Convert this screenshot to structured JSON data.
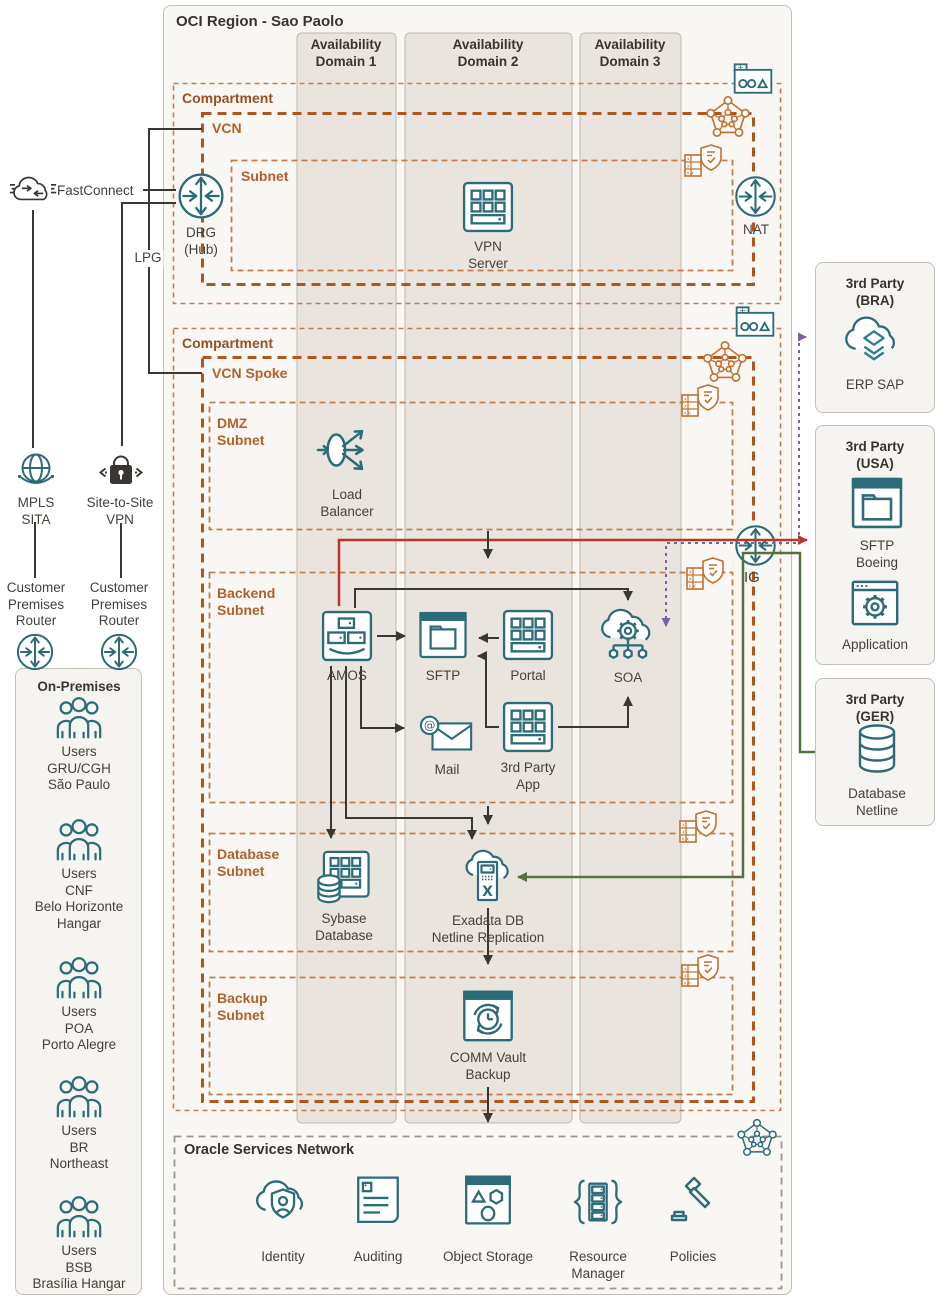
{
  "region_title": "OCI Region - Sao Paolo",
  "ad": {
    "d1": [
      "Availability",
      "Domain 1"
    ],
    "d2": [
      "Availability",
      "Domain 2"
    ],
    "d3": [
      "Availability",
      "Domain 3"
    ]
  },
  "comp1": {
    "label": "Compartment",
    "vcn_label": "VCN",
    "subnet_label": "Subnet",
    "vpn_server": [
      "VPN",
      "Server"
    ],
    "drg": [
      "DRG",
      "(Hub)"
    ],
    "nat": "NAT"
  },
  "comp2": {
    "label": "Compartment",
    "vcn_label": "VCN Spoke",
    "dmz_label": [
      "DMZ",
      "Subnet"
    ],
    "load_balancer": [
      "Load",
      "Balancer"
    ],
    "backend_label": [
      "Backend",
      "Subnet"
    ],
    "amos": "AMOS",
    "sftp": "SFTP",
    "portal": "Portal",
    "soa": "SOA",
    "mail": "Mail",
    "third_party_app": [
      "3rd Party",
      "App"
    ],
    "ig": "IG",
    "database_label": [
      "Database",
      "Subnet"
    ],
    "sybase": [
      "Sybase",
      "Database"
    ],
    "exadata": [
      "Exadata DB",
      "Netline Replication"
    ],
    "backup_label": [
      "Backup",
      "Subnet"
    ],
    "commvault": [
      "COMM Vault",
      "Backup"
    ]
  },
  "left": {
    "fastconnect": "FastConnect",
    "lpg": "LPG",
    "mpls": [
      "MPLS",
      "SITA"
    ],
    "site_to_site": [
      "Site-to-Site",
      "VPN"
    ],
    "cpr1": [
      "Customer",
      "Premises",
      "Router"
    ],
    "cpr2": [
      "Customer",
      "Premises",
      "Router"
    ]
  },
  "onprem": {
    "title": "On-Premises",
    "groups": [
      [
        "Users",
        "GRU/CGH",
        "São Paulo"
      ],
      [
        "Users",
        "CNF",
        "Belo Horizonte",
        "Hangar"
      ],
      [
        "Users",
        "POA",
        "Porto Alegre"
      ],
      [
        "Users",
        "BR",
        "Northeast"
      ],
      [
        "Users",
        "BSB",
        "Brasília Hangar"
      ]
    ]
  },
  "third_party": {
    "bra": {
      "title": [
        "3rd Party",
        "(BRA)"
      ],
      "erp": "ERP SAP"
    },
    "usa": {
      "title": [
        "3rd Party",
        "(USA)"
      ],
      "sftp": [
        "SFTP",
        "Boeing"
      ],
      "app": "Application"
    },
    "ger": {
      "title": [
        "3rd Party",
        "(GER)"
      ],
      "db": [
        "Database",
        "Netline"
      ]
    }
  },
  "osn": {
    "title": "Oracle Services Network",
    "identity": "Identity",
    "auditing": "Auditing",
    "object_storage": "Object Storage",
    "resource_manager": [
      "Resource",
      "Manager"
    ],
    "policies": "Policies"
  },
  "colors": {
    "teal": "#2c6b78",
    "orange": "#c4702f",
    "orange_dark": "#ad571c",
    "red": "#b43a25",
    "green": "#55713f",
    "purple": "#7e5fa5",
    "ink": "#3a3733"
  }
}
